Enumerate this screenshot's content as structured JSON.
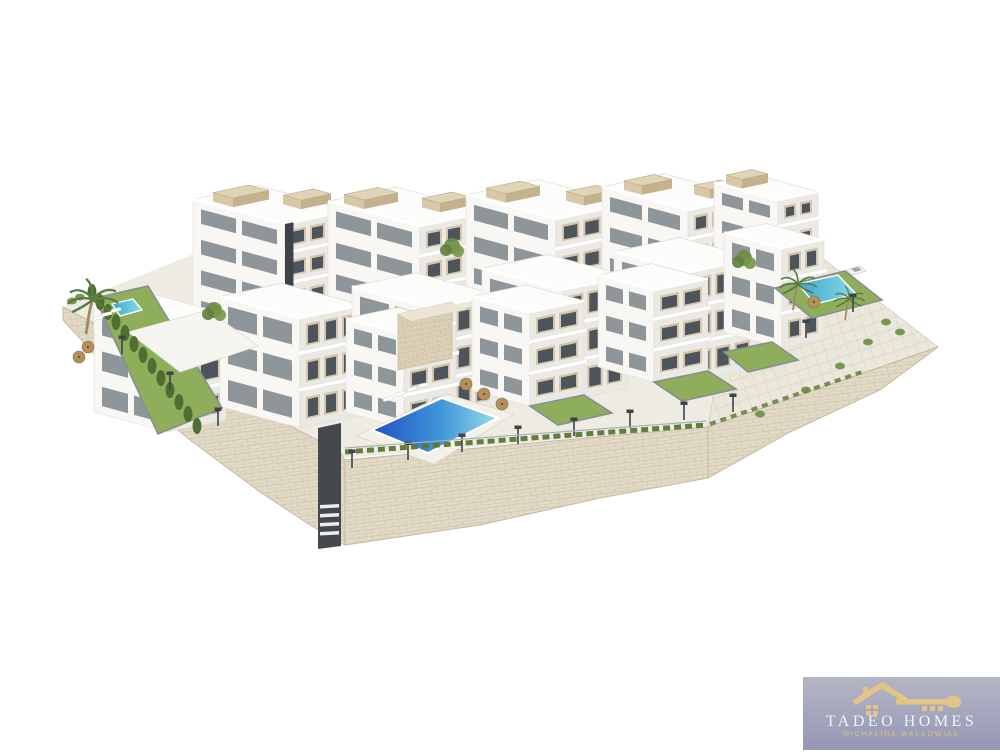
{
  "logo": {
    "brand": "TADEO HOMES",
    "subtitle": "MICHALINA WALKOWIAK",
    "colors": {
      "background_top": "#b4b5c5",
      "background_bottom": "#9496b2",
      "gold": "#e3c487",
      "text": "#f3f2f6"
    }
  },
  "scene": {
    "colors": {
      "face_left": "#f8f7f4",
      "face_right": "#ebe9e3",
      "face_top": "#fcfcfa",
      "window": "#4d545b",
      "window_side": "#667077",
      "beige": "#d3c6ad",
      "core": "#3d4349",
      "lawn": "#8fae5b",
      "lawn_border": "#868f93",
      "stone": "#e2dac7",
      "paving": "#ebe8df",
      "hedge": "#4f6e31",
      "pool_deep": "#2050c4",
      "pool_light": "#9adcea",
      "pool_small": "#46b6d6"
    },
    "base": "63,307 240,235 760,240 812,250 708,427 345,458",
    "plateau": "735,268 812,250 938,347 708,427",
    "walls": [
      "63,307 340,452 345,460 345,545 310,525 260,492 190,440 120,382 63,320",
      "345,460 708,427 708,478 600,498 480,525 345,545",
      "708,427 938,347 880,390 790,432 708,478"
    ],
    "buildings": [
      {
        "x": 285,
        "y": 346,
        "w": 65,
        "d": 92,
        "h": 122,
        "fl": 4,
        "c": 3,
        "core": [
          0.0,
          0.13
        ],
        "rb": [
          [
            6,
            58,
            36,
            20
          ],
          [
            40,
            24,
            30,
            18
          ]
        ]
      },
      {
        "x": 420,
        "y": 352,
        "w": 68,
        "d": 92,
        "h": 126,
        "fl": 4,
        "c": 3,
        "core": [
          0.8,
          0.13
        ],
        "rb": [
          [
            4,
            60,
            34,
            20
          ],
          [
            40,
            20,
            30,
            18
          ]
        ]
      },
      {
        "x": 556,
        "y": 345,
        "w": 72,
        "d": 90,
        "h": 126,
        "fl": 4,
        "c": 3,
        "core": [
          0.74,
          0.13
        ],
        "rb": [
          [
            6,
            56,
            34,
            20
          ],
          [
            44,
            16,
            30,
            18
          ]
        ]
      },
      {
        "x": 688,
        "y": 332,
        "w": 62,
        "d": 86,
        "h": 122,
        "fl": 4,
        "c": 3,
        "core": [
          0.7,
          0.13
        ],
        "rb": [
          [
            6,
            52,
            30,
            18
          ],
          [
            36,
            14,
            26,
            16
          ]
        ]
      },
      {
        "x": 778,
        "y": 312,
        "w": 40,
        "d": 64,
        "h": 112,
        "fl": 4,
        "c": 2,
        "rb": [
          [
            4,
            40,
            26,
            16
          ]
        ]
      },
      {
        "x": 168,
        "y": 432,
        "w": 58,
        "d": 74,
        "h": 106,
        "fl": 3,
        "c": 2
      },
      {
        "x": 300,
        "y": 428,
        "w": 62,
        "d": 80,
        "h": 110,
        "fl": 3,
        "c": 3
      },
      {
        "x": 432,
        "y": 420,
        "w": 64,
        "d": 80,
        "h": 112,
        "fl": 3,
        "c": 3
      },
      {
        "x": 562,
        "y": 402,
        "w": 66,
        "d": 80,
        "h": 112,
        "fl": 3,
        "c": 3
      },
      {
        "x": 690,
        "y": 382,
        "w": 66,
        "d": 76,
        "h": 110,
        "fl": 3,
        "c": 3
      },
      {
        "x": 782,
        "y": 348,
        "w": 42,
        "d": 58,
        "h": 100,
        "fl": 3,
        "c": 2
      },
      {
        "x": 404,
        "y": 428,
        "w": 52,
        "d": 58,
        "h": 94,
        "fl": 3,
        "c": 2
      },
      {
        "x": 530,
        "y": 406,
        "w": 54,
        "d": 58,
        "h": 94,
        "fl": 3,
        "c": 2
      },
      {
        "x": 654,
        "y": 382,
        "w": 54,
        "d": 56,
        "h": 92,
        "fl": 3,
        "c": 2
      }
    ],
    "gardens": [
      "396,424 444,414 470,430 420,442",
      "530,406 584,395 612,413 558,425",
      "654,382 708,371 736,389 682,401",
      "724,352 772,342 798,360 748,372",
      "95,298 148,286 222,408 158,434",
      "775,288 845,271 882,300 812,318"
    ],
    "terrace_deck": "128,332 208,310 258,346 180,372",
    "pool_deck": "356,436 446,394 514,414 434,464",
    "pool_main": "372,430 442,398 498,418 428,453",
    "pool_left": "112,304 133,299 142,310 120,316",
    "pool_right": "798,284 838,275 856,294 815,304",
    "shaft": "318,428 341,423 341,546 318,549",
    "stone_block": "398,314 452,302 452,358 398,370",
    "stone_block_top": "398,314 452,302 466,309 412,321",
    "hedge_top": [
      [
        345,
        452
      ],
      [
        706,
        425
      ]
    ],
    "hedge_right": [
      [
        710,
        424
      ],
      [
        862,
        372
      ]
    ],
    "cypress": [
      [
        92,
        292
      ],
      [
        100,
        302
      ],
      [
        108,
        312
      ],
      [
        116,
        322
      ],
      [
        125,
        333
      ],
      [
        134,
        344
      ],
      [
        143,
        355
      ],
      [
        152,
        366
      ],
      [
        161,
        378
      ],
      [
        170,
        390
      ],
      [
        179,
        402
      ],
      [
        188,
        414
      ],
      [
        197,
        426
      ]
    ],
    "lamps": [
      [
        352,
        468
      ],
      [
        408,
        460
      ],
      [
        462,
        452
      ],
      [
        518,
        444
      ],
      [
        574,
        436
      ],
      [
        630,
        428
      ],
      [
        684,
        420
      ],
      [
        733,
        412
      ],
      [
        122,
        354
      ],
      [
        170,
        390
      ],
      [
        218,
        426
      ],
      [
        806,
        338
      ],
      [
        853,
        312
      ]
    ],
    "sunbeds": [
      [
        388,
        399
      ],
      [
        400,
        394
      ],
      [
        412,
        389
      ],
      [
        424,
        385
      ],
      [
        98,
        318
      ],
      [
        107,
        314
      ],
      [
        116,
        310
      ]
    ],
    "parasols": [
      [
        466,
        384
      ],
      [
        484,
        394
      ],
      [
        502,
        404
      ],
      [
        88,
        347
      ],
      [
        79,
        357
      ],
      [
        814,
        302
      ]
    ],
    "bushes": [
      [
        886,
        322
      ],
      [
        900,
        332
      ],
      [
        868,
        342
      ],
      [
        840,
        366
      ],
      [
        806,
        390
      ],
      [
        760,
        414
      ],
      [
        72,
        301
      ],
      [
        80,
        297
      ]
    ],
    "trees": [
      [
        214,
        310
      ],
      [
        744,
        258
      ],
      [
        452,
        246
      ]
    ],
    "palms": [
      [
        86,
        334,
        1.15
      ],
      [
        793,
        310,
        0.85
      ],
      [
        845,
        320,
        0.7
      ]
    ],
    "car": {
      "x": 846,
      "y": 262
    }
  }
}
